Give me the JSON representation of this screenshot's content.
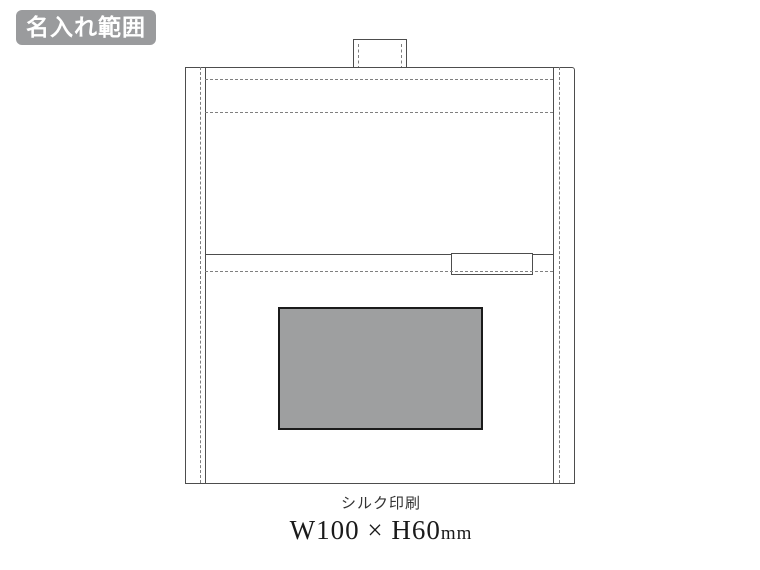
{
  "badge": {
    "label": "名入れ範囲"
  },
  "diagram": {
    "subject": "bag front with flap, handle tab, stitch lines and sewn tag",
    "print_area": {
      "shape": "rectangle",
      "fill_color": "#9e9fa0",
      "border_color": "#1b1b1b"
    }
  },
  "caption": {
    "method": "シルク印刷",
    "size_value": "W100 × H60",
    "size_unit": "mm"
  },
  "colors": {
    "badge_bg": "#9a9b9d",
    "badge_text": "#ffffff",
    "outline": "#4d4d4d",
    "stitch": "#7f7f7f",
    "background": "#ffffff"
  }
}
